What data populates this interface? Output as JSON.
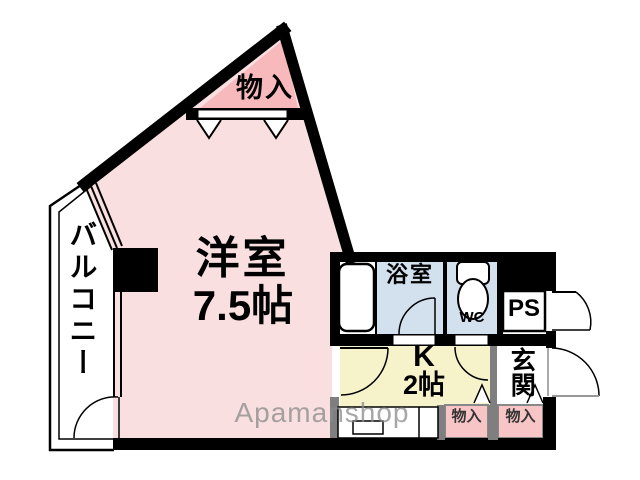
{
  "plan": {
    "rooms": {
      "main_room": {
        "label_line1": "洋室",
        "label_line2": "7.5帖"
      },
      "balcony": {
        "label": "バルコニー"
      },
      "storage_top": {
        "label": "物入"
      },
      "bathroom": {
        "label": "浴室"
      },
      "toilet": {
        "label": "WC"
      },
      "pipe_space": {
        "label": "PS"
      },
      "kitchen": {
        "label_line1": "K",
        "label_line2": "2帖"
      },
      "entrance": {
        "label": "玄関"
      },
      "storage_bottom_1": {
        "label": "物入"
      },
      "storage_bottom_2": {
        "label": "物入"
      }
    },
    "watermark": "Apamanshop",
    "colors": {
      "room_pink": "#f9dfdf",
      "storage_pink": "#f7b9bc",
      "wet_blue": "#d3e1ef",
      "kitchen_yellow": "#f6f3cb",
      "small_storage_pink": "#f7c5c5",
      "wall_black": "#000000",
      "wall_gray": "#7f7f7f",
      "watermark_gray": "#8a8a8a"
    }
  }
}
